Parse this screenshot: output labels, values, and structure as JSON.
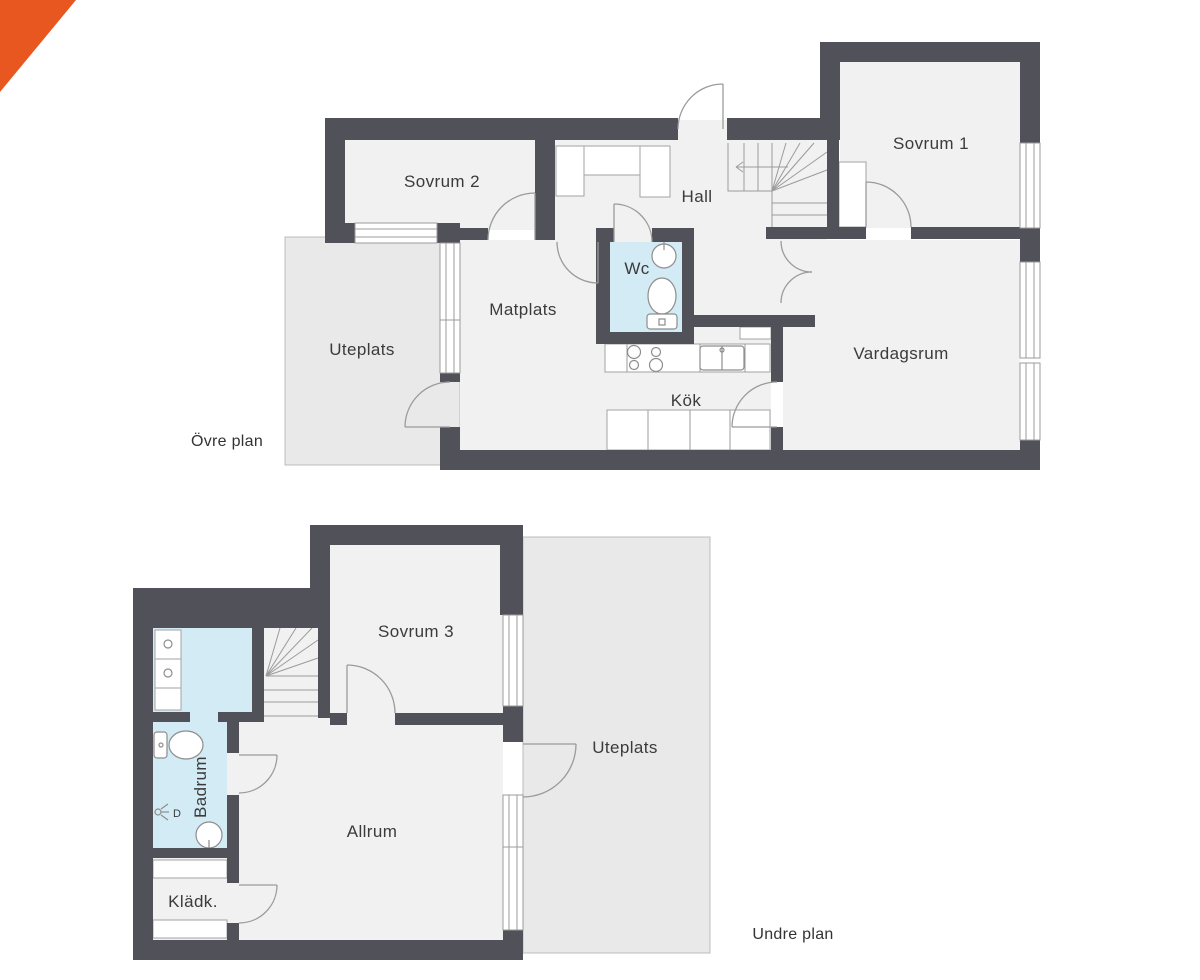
{
  "accent_color": "#e8571f",
  "palette": {
    "wall": "#51515a",
    "floor": "#f1f1f2",
    "wet_floor": "#d3ebf4",
    "patio": "#e9e9e9",
    "patio_border": "#bcbcbc",
    "line": "#9b9b9b",
    "fixture": "#8d8d8d",
    "label": "#3b3b3b"
  },
  "upper_floor": {
    "plan_label": "Övre plan",
    "rooms": {
      "sovrum2": "Sovrum 2",
      "hall": "Hall",
      "sovrum1": "Sovrum 1",
      "wc": "Wc",
      "matplats": "Matplats",
      "uteplats": "Uteplats",
      "vardagsrum": "Vardagsrum",
      "kok": "Kök"
    }
  },
  "lower_floor": {
    "plan_label": "Undre plan",
    "rooms": {
      "sovrum3": "Sovrum 3",
      "uteplats": "Uteplats",
      "badrum": "Badrum",
      "allrum": "Allrum",
      "kladk": "Klädk."
    },
    "fixture_labels": {
      "shower": "D"
    }
  }
}
